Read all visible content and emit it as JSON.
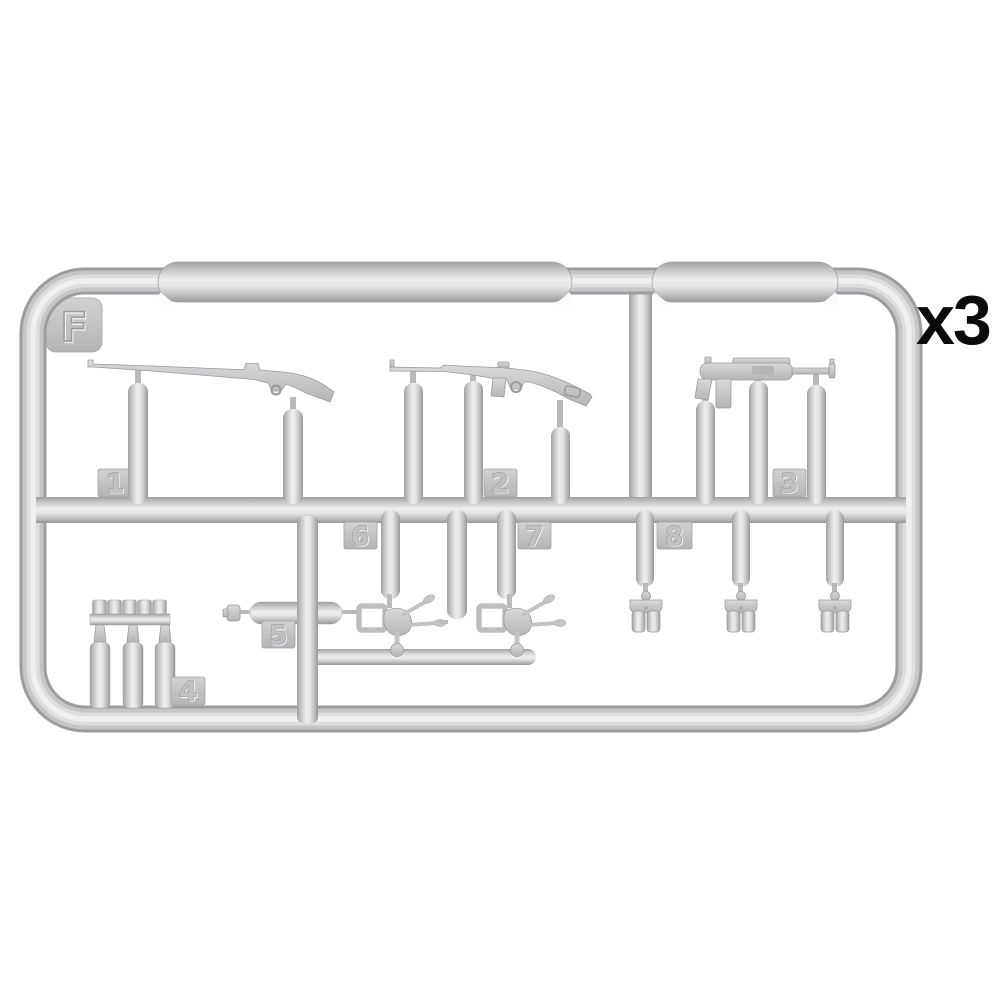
{
  "illustration": {
    "kind": "plastic-model-sprue",
    "sprue_letter": "F",
    "multiplier_label": "x3",
    "colors": {
      "background": "#ffffff",
      "plastic_base": "#c9c9cb",
      "plastic_highlight": "#f0f0f2",
      "plastic_shadow": "#98989a",
      "label_text": "#0b0b0b"
    },
    "tabs": {
      "n1": "1",
      "n2": "2",
      "n3": "3",
      "n4": "4",
      "n5": "5",
      "n6": "6",
      "n7": "7",
      "n8": "8"
    },
    "parts": [
      {
        "tab": "1",
        "name": "rifle",
        "count": 1
      },
      {
        "tab": "2",
        "name": "carbine-with-stock-slot",
        "count": 1
      },
      {
        "tab": "3",
        "name": "submachine-gun",
        "count": 1
      },
      {
        "tab": "4",
        "name": "bottle-and-cap-rack",
        "count": 1
      },
      {
        "tab": "5",
        "name": "cylinder-with-nozzle",
        "count": 1
      },
      {
        "tab": "6",
        "name": "folded-bracket",
        "count": 1
      },
      {
        "tab": "7",
        "name": "folded-bracket",
        "count": 1
      },
      {
        "tab": "8",
        "name": "double-ammo-pouch",
        "count": 3
      }
    ]
  }
}
